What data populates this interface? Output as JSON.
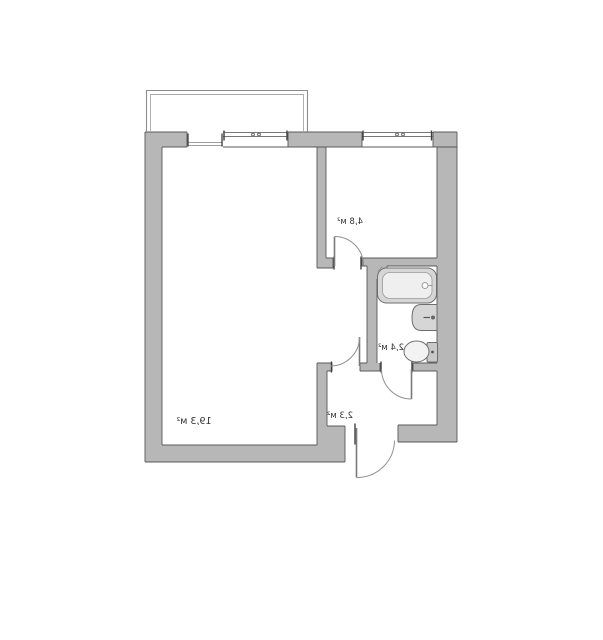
{
  "floor_plan": {
    "rooms": [
      {
        "name": "living-room",
        "area_label": "19,3 м²"
      },
      {
        "name": "bedroom",
        "area_label": "4,8 м²"
      },
      {
        "name": "bathroom",
        "area_label": "2,4 м²"
      },
      {
        "name": "hallway",
        "area_label": "2,3 м²"
      }
    ],
    "fixtures": [
      "bathtub",
      "sink",
      "toilet"
    ],
    "features": [
      "balcony",
      "windows",
      "door-swing-arcs",
      "vent-shaft"
    ],
    "labels_mirrored": true,
    "colors": {
      "background": "#ffffff",
      "wall_fill": "#b7b7b7",
      "wall_stroke": "#585858",
      "window_line": "#666666",
      "sill_line": "#7d7d7d",
      "jamb_mark": "#3e3e3e",
      "door_leaf": "#7a7a7a",
      "door_arc": "#909090",
      "balcony_outer": "#8d8d8d",
      "balcony_inner": "#a8a8a8",
      "fixture_fill": "#d6d6d6",
      "fixture_inner": "#efefef",
      "fixture_stroke": "#6e6e6e",
      "label_color": "#333333"
    }
  }
}
